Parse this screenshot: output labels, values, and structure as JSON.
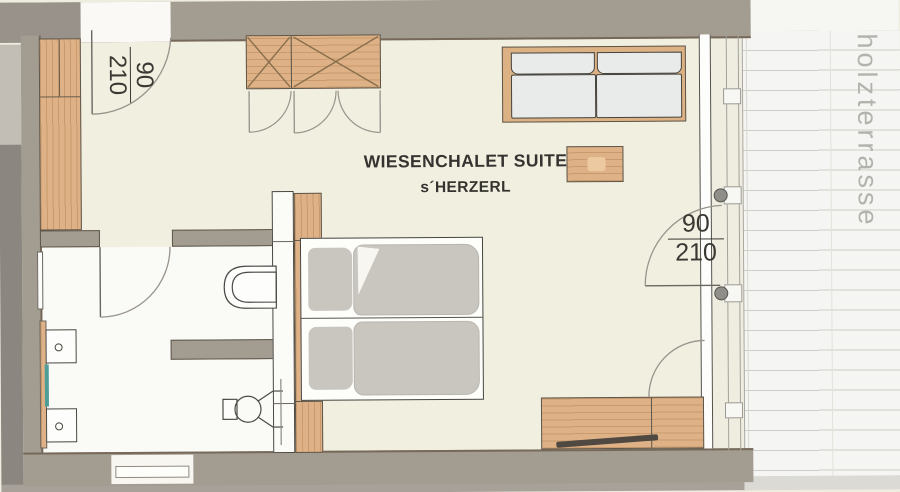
{
  "title": {
    "line1": "WIESENCHALET SUITE",
    "line2": "s´HERZERL"
  },
  "doors": {
    "entry": {
      "width": "90",
      "height": "210"
    },
    "terrace": {
      "width": "90",
      "height": "210"
    }
  },
  "terrace": {
    "label": "holzterrasse"
  },
  "colors": {
    "wall": "#a39c91",
    "wall_edge": "#77695a",
    "room_floor": "#f1efe0",
    "bathroom_floor": "#fafaf6",
    "wood": "#deb286",
    "bedding_gray": "#c9c6c0",
    "sofa_cushion": "#e9ebeb",
    "teal_accent": "#4f9d98",
    "terrace_plank_line": "#cdcdc6",
    "terrace_text": "#b3b2ac",
    "label_text": "#3a3833"
  }
}
